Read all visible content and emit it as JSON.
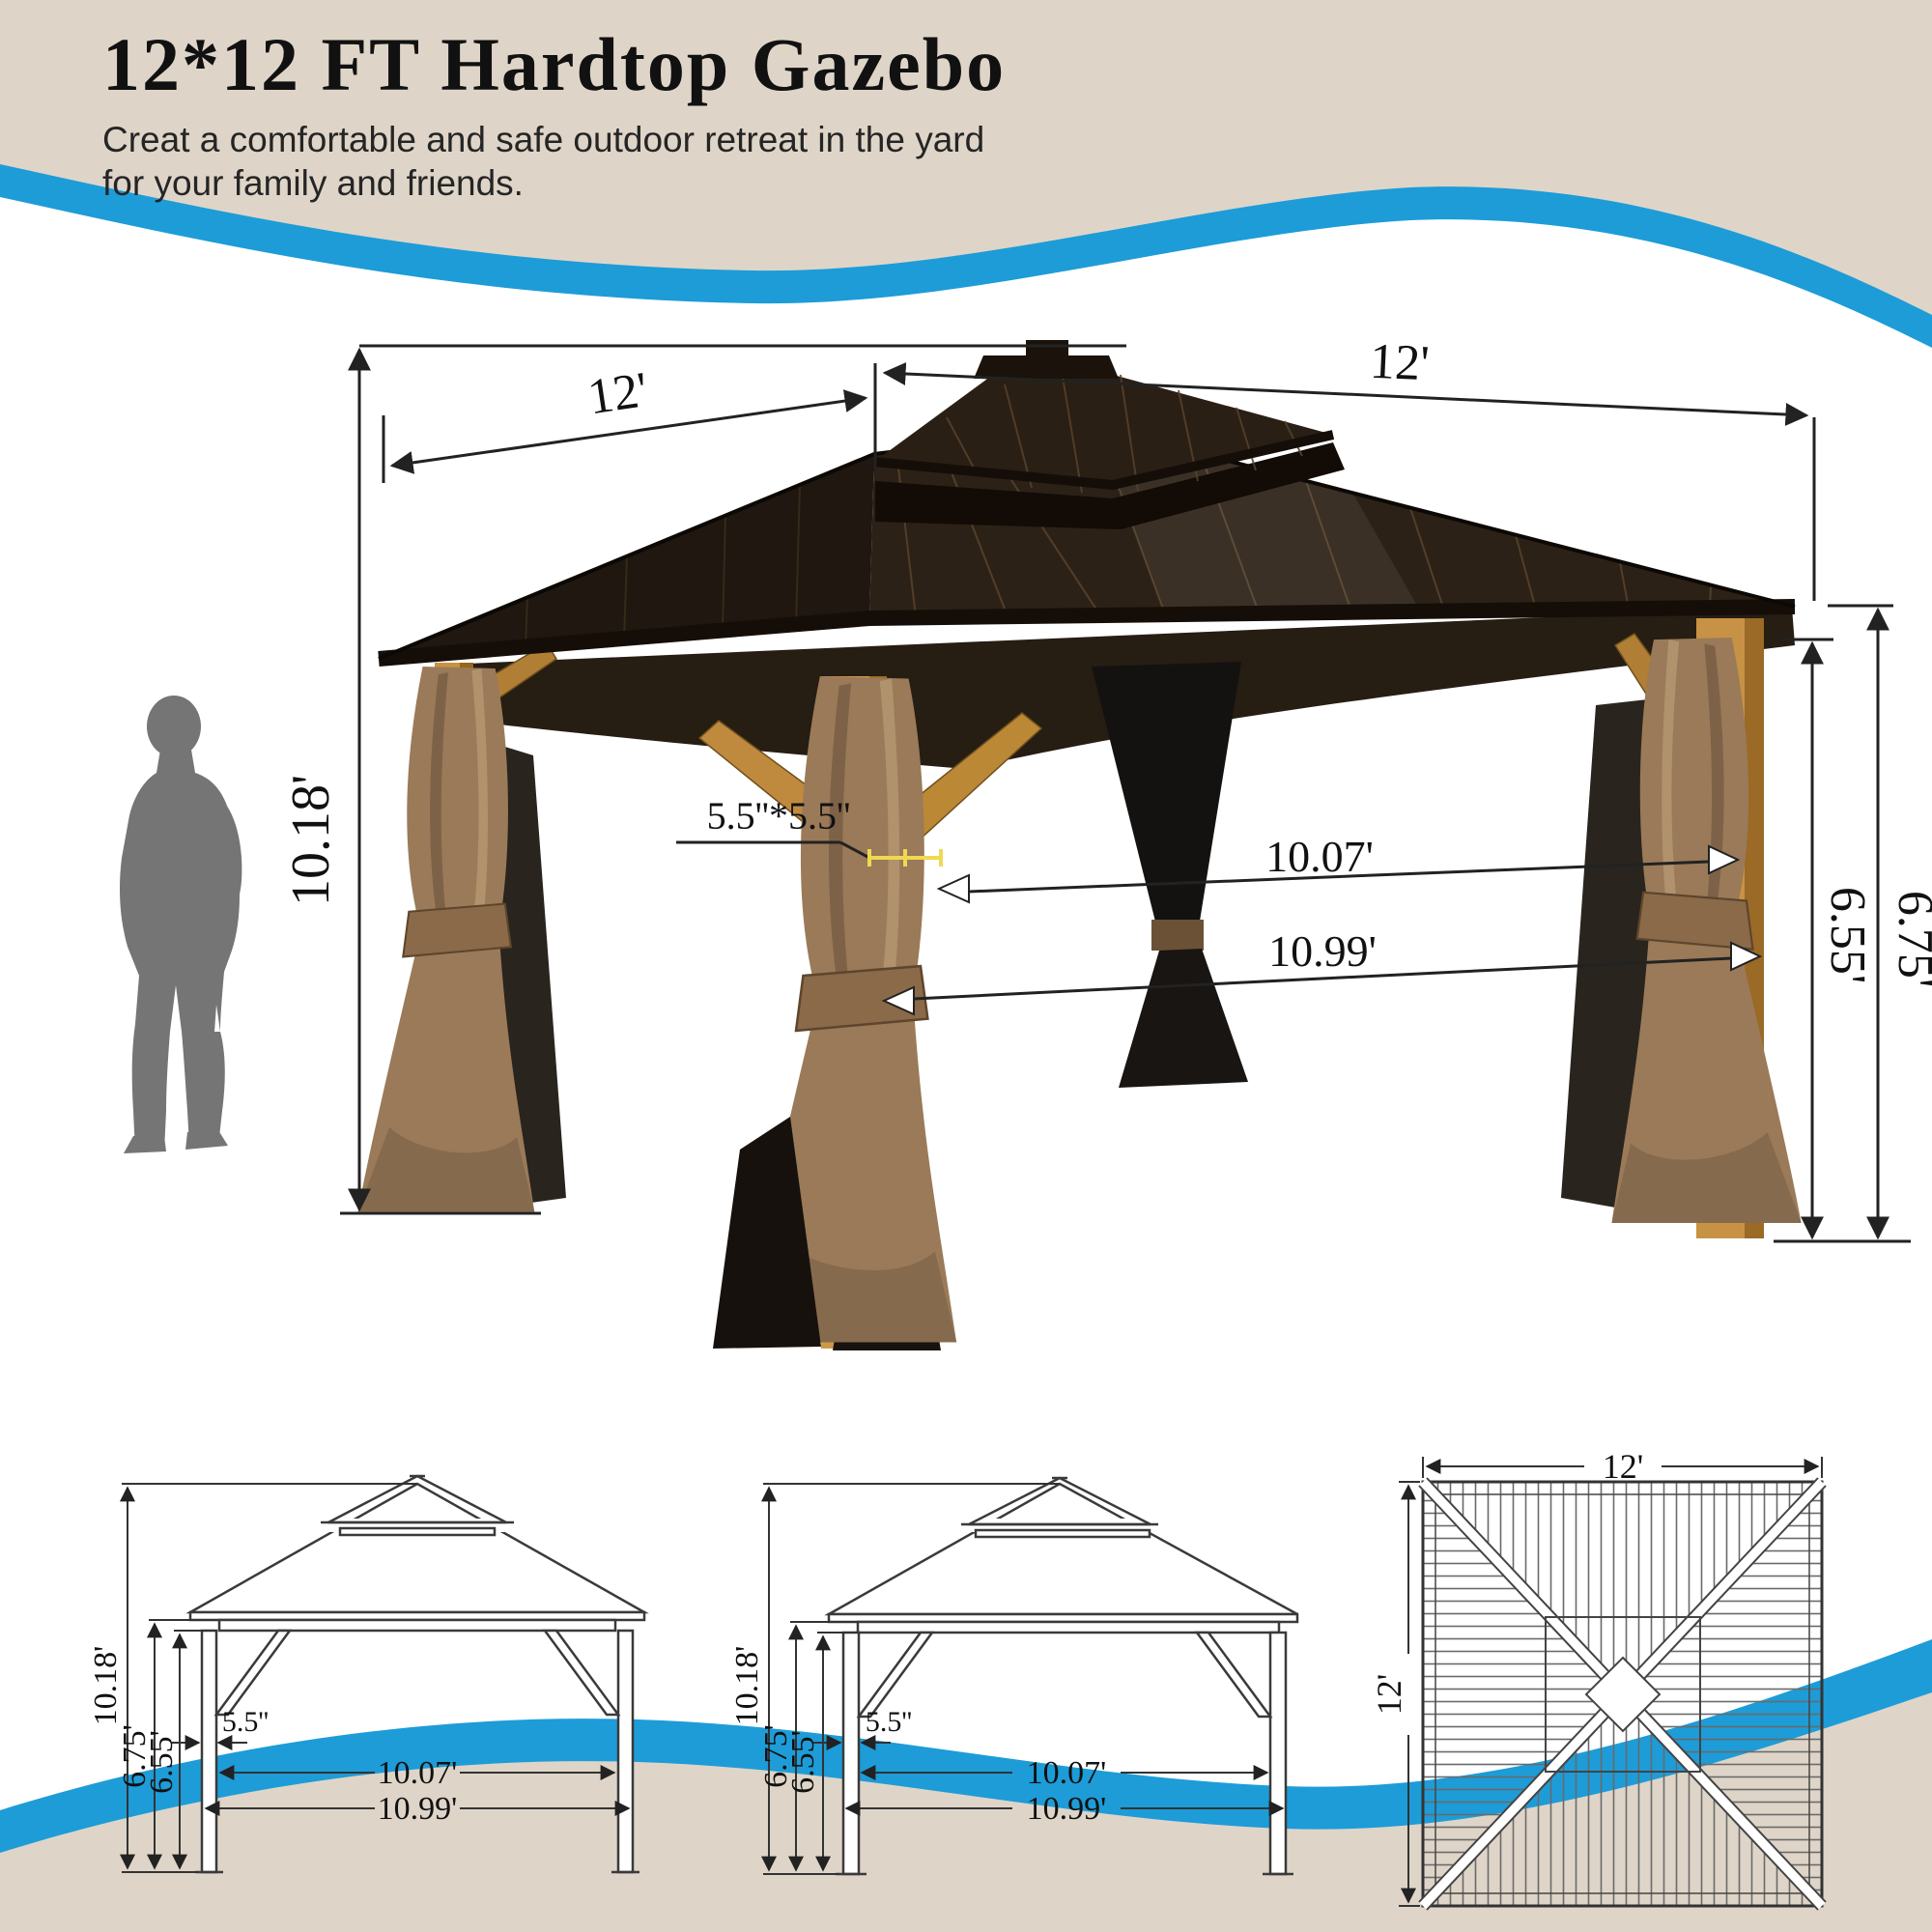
{
  "header": {
    "title": "12*12 FT Hardtop Gazebo",
    "subtitle1": "Creat a comfortable and safe outdoor retreat in the yard",
    "subtitle2": "for your family and friends."
  },
  "colors": {
    "beige": "#ded5c8",
    "blue": "#1d9cd8",
    "wood": "#c89243",
    "roof_dark": "#241a10",
    "curtain": "#9a7a58",
    "mesh": "#17110b",
    "silhouette": "#757575",
    "dim_line": "#222222",
    "measure_yellow": "#f0d852"
  },
  "photo": {
    "height": "10.18'",
    "roof_left": "12'",
    "roof_right": "12'",
    "post_section": "5.5''*5.5''",
    "span_inner": "10.07'",
    "span_outer": "10.99'",
    "eave_inner": "6.55'",
    "eave_outer": "6.75'"
  },
  "front_view": {
    "height": "10.18'",
    "post_outer": "6.75'",
    "post_inner": "6.55'",
    "post_width": "5.5''",
    "span_inner": "10.07'",
    "span_outer": "10.99'"
  },
  "side_view": {
    "height": "10.18'",
    "post_outer": "6.75'",
    "post_inner": "6.55'",
    "post_width": "5.5''",
    "span_inner": "10.07'",
    "span_outer": "10.99'"
  },
  "top_view": {
    "width": "12'",
    "depth": "12'"
  }
}
